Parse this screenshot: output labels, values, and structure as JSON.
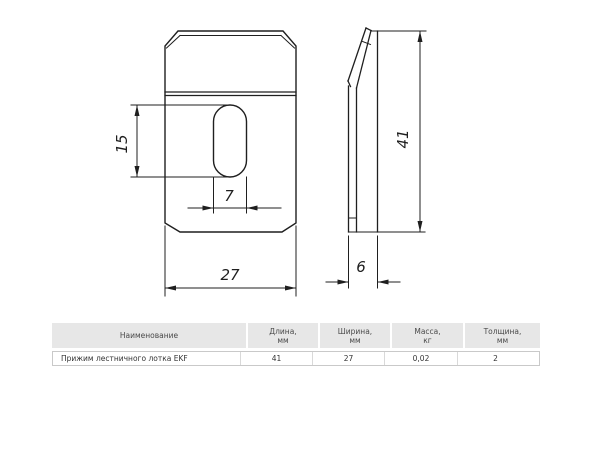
{
  "page": {
    "background": "#ffffff"
  },
  "drawing": {
    "line_color": "#1f1f1f",
    "front_view": {
      "slot_height_label": "15",
      "slot_width_label": "7",
      "width_label": "27"
    },
    "side_view": {
      "height_label": "41",
      "depth_label": "6"
    }
  },
  "table": {
    "header_bg": "#e7e7e7",
    "border_color": "#c9c9c9",
    "columns": [
      {
        "id": "name",
        "line1": "Наименование",
        "line2": ""
      },
      {
        "id": "length",
        "line1": "Длина,",
        "line2": "мм"
      },
      {
        "id": "width",
        "line1": "Ширина,",
        "line2": "мм"
      },
      {
        "id": "mass",
        "line1": "Масса,",
        "line2": "кг"
      },
      {
        "id": "thickness",
        "line1": "Толщина,",
        "line2": "мм"
      }
    ],
    "rows": [
      {
        "name": "Прижим лестничного лотка EKF",
        "length": "41",
        "width": "27",
        "mass": "0,02",
        "thickness": "2"
      }
    ]
  }
}
